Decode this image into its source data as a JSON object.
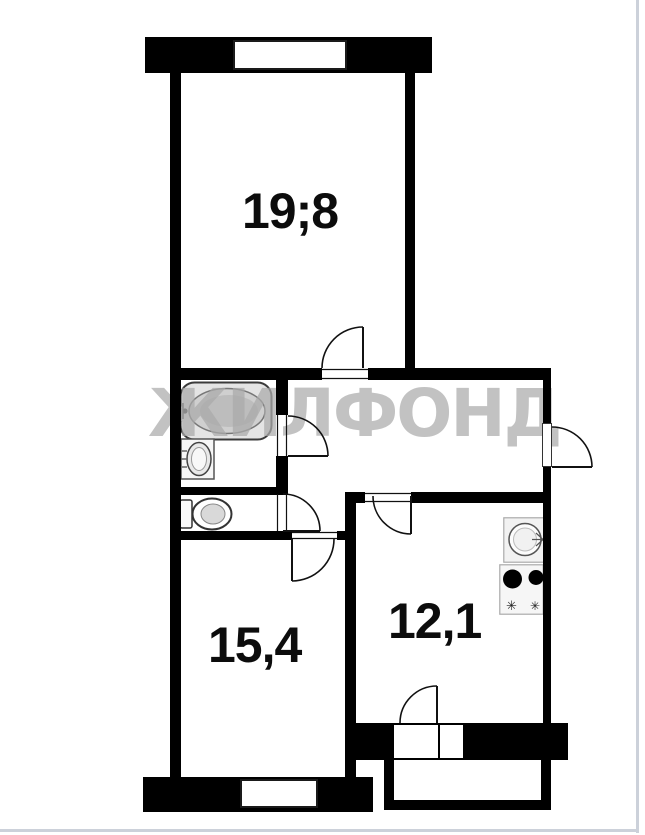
{
  "watermark": {
    "text": "ЖИЛФОНД",
    "color": "#ababab"
  },
  "rooms": {
    "living": {
      "area_label": "19;8"
    },
    "bedroom": {
      "area_label": "15,4"
    },
    "kitchen": {
      "area_label": "12,1"
    }
  },
  "fixtures": {
    "bathtub": "bathtub",
    "washbasin": "washbasin",
    "toilet": "toilet",
    "kitchen_sink": "kitchen-sink",
    "stove": "stove-2-burner",
    "burner_glyph": "✳"
  },
  "colors": {
    "wall": "#000000",
    "door_line": "#111111",
    "watermark": "#ababab",
    "page_edge": "#ccd1da"
  }
}
